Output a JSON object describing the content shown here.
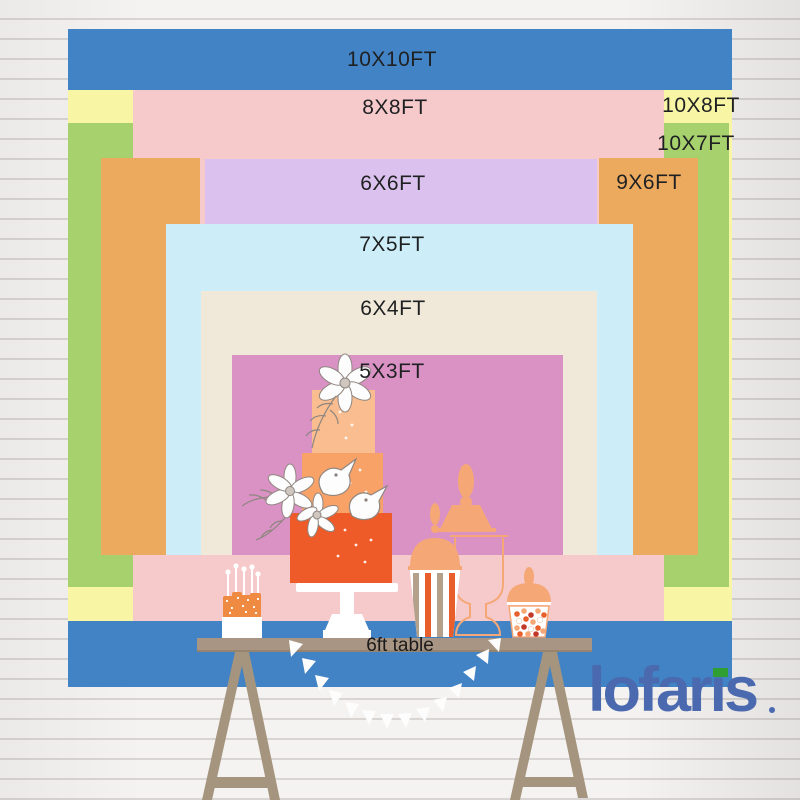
{
  "sizes": [
    {
      "id": "10x10",
      "label": "10X10FT",
      "color": "#4183c4"
    },
    {
      "id": "10x8",
      "label": "10X8FT",
      "color": "#f8f6a4"
    },
    {
      "id": "10x7",
      "label": "10X7FT",
      "color": "#a7d16d"
    },
    {
      "id": "8x8",
      "label": "8X8FT",
      "color": "#f6c9cb"
    },
    {
      "id": "9x6",
      "label": "9X6FT",
      "color": "#ecaa5f"
    },
    {
      "id": "6x6",
      "label": "6X6FT",
      "color": "#dbc2ee"
    },
    {
      "id": "7x5",
      "label": "7X5FT",
      "color": "#cdeef8"
    },
    {
      "id": "6x4",
      "label": "6X4FT",
      "color": "#f0e9d9"
    },
    {
      "id": "5x3",
      "label": "5X3FT",
      "color": "#da92c5"
    }
  ],
  "table": {
    "label": "6ft table",
    "color": "#a89583",
    "trestle_color": "#a5957f"
  },
  "branding": {
    "logo_text": "lofaris",
    "logo_color": "#4a69af",
    "logo_accent_color": "#2f9e33"
  },
  "illustration": {
    "icons": [
      "tiered-cake-icon",
      "cake-stand-icon",
      "flower-icon",
      "bird-icon",
      "cake-pops-icon",
      "popcorn-box-icon",
      "candy-jar-silhouette-icon",
      "candy-jar-outline-icon",
      "candy-cup-icon",
      "bunting-garland-icon",
      "trestle-table-icon"
    ],
    "accent_colors": {
      "peach": "#f5a876",
      "cake_top_tier": "#f9bd8f",
      "cake_middle_tier": "#f8a268",
      "cake_bottom_tier": "#ee5b28",
      "stripe_taupe": "#b3a18c",
      "stripe_orange": "#e85f2b"
    }
  }
}
